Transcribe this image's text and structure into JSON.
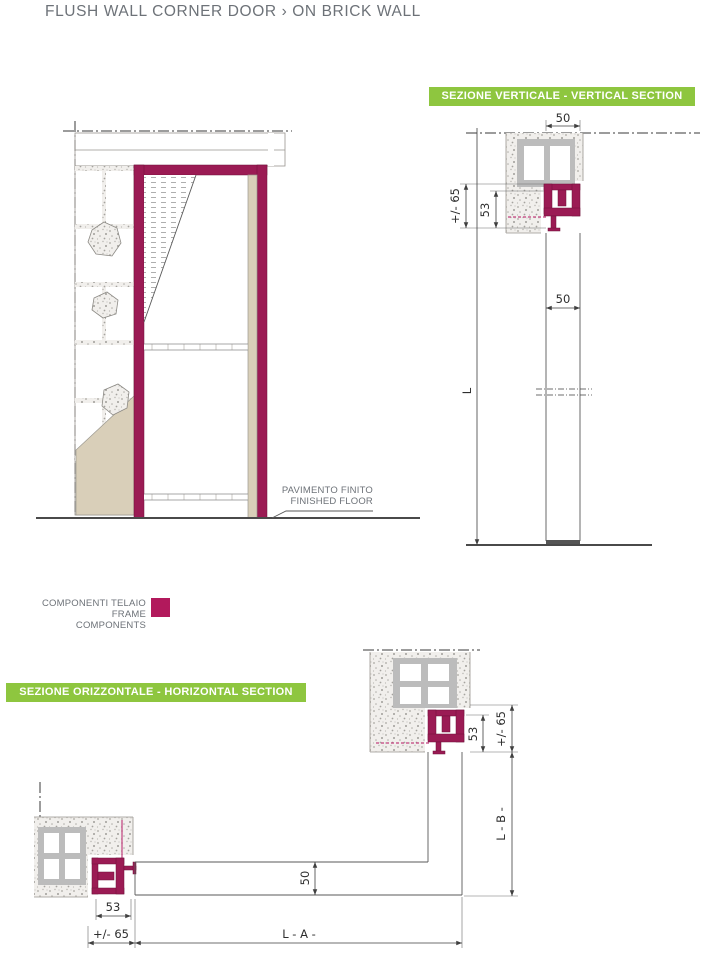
{
  "title": "FLUSH WALL CORNER DOOR › ON BRICK WALL",
  "banners": {
    "vertical": "SEZIONE VERTICALE - VERTICAL SECTION",
    "horizontal": "SEZIONE ORIZZONTALE - HORIZONTAL SECTION"
  },
  "legend": {
    "line1": "COMPONENTI TELAIO",
    "line2": "FRAME COMPONENTS"
  },
  "floor_label": {
    "line1": "PAVIMENTO FINITO",
    "line2": "FINISHED FLOOR"
  },
  "dims": {
    "vs_top_width": "50",
    "vs_frame_total": "+/- 65",
    "vs_frame_depth": "53",
    "vs_height": "L",
    "vs_door_thickness": "50",
    "hs_top_frame_depth": "53",
    "hs_top_frame_total": "+/- 65",
    "hs_width_b": "L - B -",
    "hs_door_thickness": "50",
    "hs_left_frame_depth": "53",
    "hs_left_frame_total": "+/- 65",
    "hs_width_a": "L - A -"
  },
  "colors": {
    "accent_green": "#8ec63f",
    "frame_magenta": "#9b1b54",
    "legend_swatch": "#b2195c",
    "title_gray": "#6d7278",
    "plaster_tan": "#d9cfb9"
  }
}
